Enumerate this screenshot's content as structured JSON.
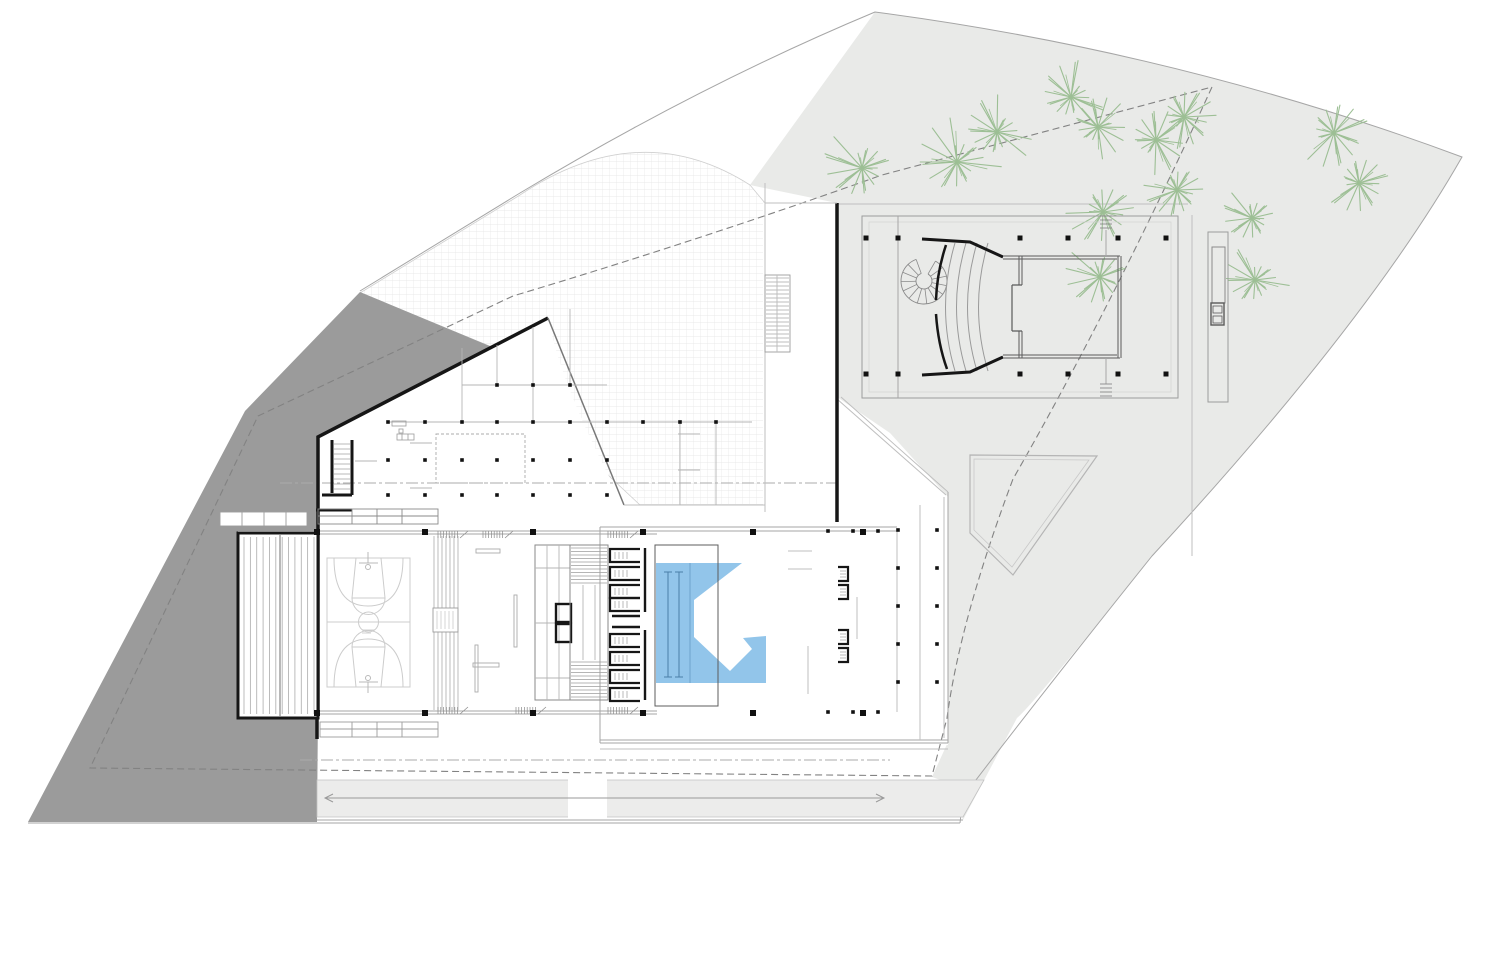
{
  "drawing": {
    "kind": "architectural site / floor plan (sports and cultural center)",
    "colors": {
      "background": "#ffffff",
      "site_gray": "#e9eae8",
      "road_gray": "#ececeb",
      "dark_gray": "#9b9b9b",
      "wall_black": "#161616",
      "line_gray": "#9a9a9a",
      "light_line": "#c4c4c4",
      "court_line": "#cccccc",
      "grid_line": "#e4e4e4",
      "pool_blue": "#92c5ea",
      "lane_blue": "#4a7fa8",
      "tree_green": "#9dbf95"
    },
    "pool": {
      "points": "656,563 742,563 694,600 694,637 730,671 752,649 743,638 766,636 766,683 656,683",
      "lanes_x": [
        668,
        679
      ],
      "lane_y": [
        572,
        677
      ],
      "edge_x": 690,
      "overlay_rect": [
        655,
        545,
        63,
        161
      ]
    },
    "trees": [
      {
        "x": 862,
        "y": 168,
        "r": 34
      },
      {
        "x": 957,
        "y": 162,
        "r": 36
      },
      {
        "x": 997,
        "y": 132,
        "r": 30
      },
      {
        "x": 1071,
        "y": 97,
        "r": 30
      },
      {
        "x": 1098,
        "y": 127,
        "r": 26
      },
      {
        "x": 1156,
        "y": 140,
        "r": 28
      },
      {
        "x": 1184,
        "y": 117,
        "r": 26
      },
      {
        "x": 1334,
        "y": 133,
        "r": 30
      },
      {
        "x": 1359,
        "y": 183,
        "r": 27
      },
      {
        "x": 1103,
        "y": 212,
        "r": 30
      },
      {
        "x": 1177,
        "y": 190,
        "r": 27
      },
      {
        "x": 1100,
        "y": 277,
        "r": 30
      },
      {
        "x": 1252,
        "y": 218,
        "r": 26
      },
      {
        "x": 1255,
        "y": 280,
        "r": 28
      }
    ],
    "columns": {
      "big": {
        "size": 6,
        "rows": [
          {
            "y": 532,
            "x": [
              317,
              425,
              533,
              643,
              753,
              863
            ]
          },
          {
            "y": 713,
            "x": [
              317,
              425,
              533,
              643,
              753,
              863
            ]
          }
        ]
      },
      "small": {
        "size": 3.6,
        "rows": [
          {
            "y": 385,
            "x": [
              497,
              533,
              570
            ]
          },
          {
            "y": 422,
            "x": [
              388,
              425,
              462,
              497,
              533,
              570,
              607,
              643,
              680,
              716
            ]
          },
          {
            "y": 460,
            "x": [
              388,
              425,
              462,
              497,
              533,
              570,
              607
            ]
          },
          {
            "y": 495,
            "x": [
              388,
              425,
              462,
              497,
              533,
              570,
              607
            ]
          },
          {
            "y": 531,
            "x": [
              828,
              853,
              878
            ]
          },
          {
            "y": 712,
            "x": [
              828,
              853,
              878
            ]
          },
          {
            "y": 530,
            "x": [
              898,
              937
            ]
          },
          {
            "y": 568,
            "x": [
              898,
              937
            ]
          },
          {
            "y": 606,
            "x": [
              898,
              937
            ]
          },
          {
            "y": 644,
            "x": [
              898,
              937
            ]
          },
          {
            "y": 682,
            "x": [
              898,
              937
            ]
          }
        ]
      },
      "auditorium": {
        "size": 5,
        "rows": [
          {
            "y": 238,
            "x": [
              866,
              898,
              1020,
              1068,
              1118,
              1166
            ]
          },
          {
            "y": 374,
            "x": [
              866,
              898,
              1020,
              1068,
              1118,
              1166
            ]
          }
        ]
      }
    },
    "west_bleachers": {
      "x1": 244,
      "x2": 314,
      "count": 12,
      "y1": 537,
      "y2": 714,
      "divider_x": 280,
      "frame": [
        238,
        533,
        80,
        185
      ]
    },
    "east_bleachers": {
      "xs": [
        434,
        438,
        442,
        446,
        450,
        454,
        458
      ],
      "y1": 536,
      "y2": 710,
      "gap": [
        608,
        632
      ],
      "box": [
        433,
        608,
        25,
        24
      ]
    },
    "seating_arcs": {
      "count": 4,
      "x0": 955,
      "dx": 11,
      "y_top": 243,
      "y_bot": 371,
      "bulge": 19
    },
    "spiral_stair": {
      "cx": 924,
      "cy": 281,
      "r_out": 23,
      "r_in": 8,
      "a0": -60,
      "a1": 250,
      "steps": 13
    },
    "stair_hatch": {
      "x1": 571,
      "x2": 607,
      "top": [
        548,
        583
      ],
      "bottom": [
        662,
        697
      ],
      "step": 3.5
    },
    "ne_stair_strip": {
      "rect": [
        765,
        275,
        25,
        77
      ],
      "step": 4
    },
    "locker_stalls": {
      "x_open": 640,
      "x_back": 610,
      "h": 13,
      "ys": [
        549,
        567,
        585,
        598,
        634,
        652,
        670,
        688
      ]
    },
    "deck_brackets": {
      "x_open": 838,
      "x_back": 848,
      "h": 14,
      "ys": [
        567,
        585,
        630,
        648
      ]
    },
    "grille_combs": [
      [
        438,
        531
      ],
      [
        483,
        531
      ],
      [
        608,
        531
      ],
      [
        438,
        707
      ],
      [
        516,
        707
      ],
      [
        608,
        707
      ]
    ],
    "stage_axis_hatch": [
      [
        1100,
        216,
        230
      ],
      [
        1100,
        384,
        398
      ]
    ],
    "road": {
      "polygon": "317,780 984,780 963,817 317,817",
      "median": [
        568,
        778,
        39,
        41
      ],
      "lane_y": 798,
      "lane_x1": 325,
      "lane_x2": 884
    }
  }
}
